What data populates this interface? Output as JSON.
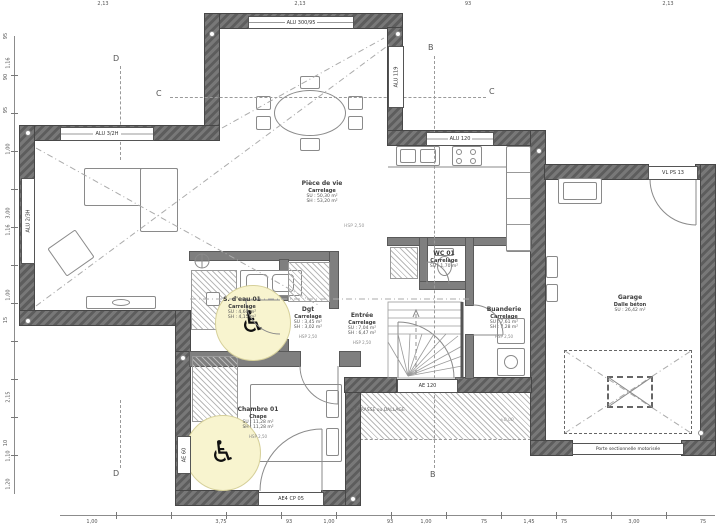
{
  "meta": {
    "drawing_type": "Plan rez-de-chaussée"
  },
  "colors": {
    "wall": "#5d5d5d",
    "accessible_zone": "#f8f4cf",
    "line": "#8a8a8a",
    "text": "#3c3c3c"
  },
  "symbols": {
    "wheelchair": "♿"
  },
  "sections": {
    "b": "B",
    "c": "C",
    "d": "D"
  },
  "rooms": {
    "piece_de_vie": {
      "name": "Pièce de vie",
      "floor": "Carrelage",
      "su": "SU : 50,30 m²",
      "sh": "SH : 53,20 m²",
      "hsp": "HSP 2,50"
    },
    "sdeau": {
      "name": "S. d'eau 01",
      "floor": "Carrelage",
      "su": "SU : 4,60 m²",
      "sh": "SH : 4,15 m²"
    },
    "dgt": {
      "name": "Dgt",
      "floor": "Carrelage",
      "su": "SU : 3,45 m²",
      "sh": "SH : 3,02 m²",
      "hsp": "HSP 2,50"
    },
    "entree": {
      "name": "Entrée",
      "floor": "Carrelage",
      "su": "SU : 7,04 m²",
      "sh": "SH : 6,47 m²",
      "hsp": "HSP 2,50"
    },
    "wc": {
      "name": "WC 01",
      "floor": "Carrelage",
      "su": "SU : 1,70 m²"
    },
    "buanderie": {
      "name": "Buanderie",
      "floor": "Carrelage",
      "su": "SU : 7,61 m²",
      "sh": "SH : 7,28 m²",
      "hsp": "HSP 2,50"
    },
    "chambre": {
      "name": "Chambre 01",
      "floor": "Chape",
      "su": "SU : 11,28 m²",
      "sh": "SH : 11,28 m²",
      "hsp": "HSP 2,50"
    },
    "garage": {
      "name": "Garage",
      "floor": "Dalle béton",
      "su": "SU : 26,42 m²"
    }
  },
  "openings": {
    "top_window": "ALU 300/95",
    "dining_window": "ALU 119",
    "west_high_window": "ALU 3/2H",
    "west_window": "ALU 2/3H",
    "kitchen_window": "ALU 120",
    "front_door": "AE 120",
    "garage_service_door": "VL PS 13",
    "bedroom_window": "AE 60",
    "bedroom_french_door": "AE4 CP 05"
  },
  "annotations": {
    "terrace": "TERRASSE ou DALLAGE",
    "garage_door": "Porte sectionnelle motorisée",
    "level": "±0,00"
  },
  "dimensions": {
    "top": [
      {
        "t": "2,13",
        "x": 103
      },
      {
        "t": "2,13",
        "x": 300
      },
      {
        "t": "93",
        "x": 468
      },
      {
        "t": "2,13",
        "x": 668
      }
    ],
    "bottom": [
      {
        "t": "1,00",
        "x": 92
      },
      {
        "t": "3,75",
        "x": 221
      },
      {
        "t": "93",
        "x": 289
      },
      {
        "t": "1,00",
        "x": 329
      },
      {
        "t": "93",
        "x": 390
      },
      {
        "t": "1,00",
        "x": 426
      },
      {
        "t": "75",
        "x": 484
      },
      {
        "t": "1,45",
        "x": 529
      },
      {
        "t": "75",
        "x": 564
      },
      {
        "t": "3,00",
        "x": 634
      },
      {
        "t": "75",
        "x": 703
      }
    ],
    "left": [
      {
        "t": "95",
        "y": 33
      },
      {
        "t": "1,16",
        "y": 60
      },
      {
        "t": "90",
        "y": 74
      },
      {
        "t": "95",
        "y": 107
      },
      {
        "t": "1,00",
        "y": 146
      },
      {
        "t": "3,00",
        "y": 210
      },
      {
        "t": "1,16",
        "y": 227
      },
      {
        "t": "1,00",
        "y": 292
      },
      {
        "t": "15",
        "y": 317
      },
      {
        "t": "2,15",
        "y": 394
      },
      {
        "t": "10",
        "y": 440
      },
      {
        "t": "1,10",
        "y": 453
      },
      {
        "t": "1,20",
        "y": 481
      }
    ]
  }
}
